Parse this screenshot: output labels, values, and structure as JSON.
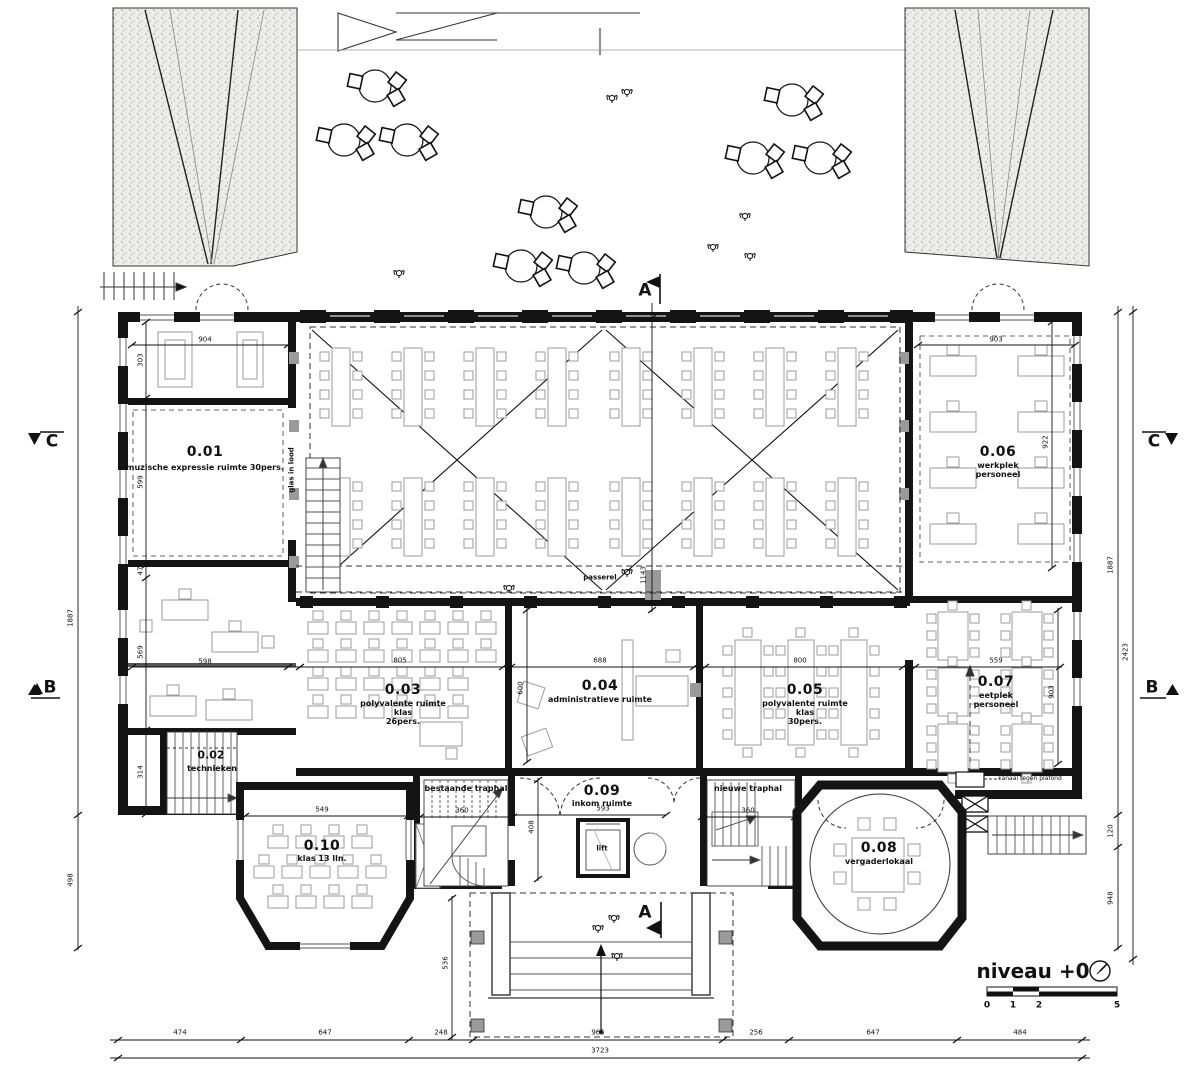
{
  "title": {
    "level_label": "niveau +0"
  },
  "scale_bar": {
    "t0": "0",
    "t1": "1",
    "t2": "2",
    "t5": "5"
  },
  "section_markers": {
    "a": "A",
    "b": "B",
    "c": "C"
  },
  "rooms": [
    {
      "number": "0.01",
      "lines": [
        "muzische expressie ruimte 30pers."
      ]
    },
    {
      "number": "0.02",
      "lines": [
        "technieken"
      ]
    },
    {
      "number": "0.03",
      "lines": [
        "polyvalente ruimte",
        "klas",
        "26pers."
      ]
    },
    {
      "number": "0.04",
      "lines": [
        "administratieve ruimte"
      ]
    },
    {
      "number": "0.05",
      "lines": [
        "polyvalente ruimte",
        "klas",
        "30pers."
      ]
    },
    {
      "number": "0.06",
      "lines": [
        "werkplek",
        "personeel"
      ]
    },
    {
      "number": "0.07",
      "lines": [
        "eetplek",
        "personeel"
      ]
    },
    {
      "number": "0.08",
      "lines": [
        "vergaderlokaal"
      ]
    },
    {
      "number": "0.09",
      "lines": [
        "inkom ruimte"
      ]
    },
    {
      "number": "0.10",
      "lines": [
        "klas 13 lln."
      ]
    }
  ],
  "annotations": {
    "glas_in_lood": "glas in lood",
    "passerel": "passerel",
    "bestaande_traphal": "bestaande traphal",
    "nieuwe_traphal": "nieuwe traphal",
    "lift": "lift",
    "kanaal": "kanaal tegen plafond"
  },
  "dimensions": {
    "bottom": [
      "474",
      "647",
      "248",
      "965",
      "256",
      "647",
      "484"
    ],
    "bottom_total": "3723",
    "left": [
      "1887",
      "498"
    ],
    "right": [
      "1887",
      "120",
      "948"
    ],
    "right_outer": "2423",
    "interior": {
      "d904": "904",
      "d303": "303",
      "d599": "599",
      "d47": "47",
      "d569": "569",
      "d598": "598",
      "d314": "314",
      "d805": "805",
      "d688": "688",
      "d600": "600",
      "d800": "800",
      "d559": "559",
      "d903_top": "903",
      "d922": "922",
      "d903_right": "903",
      "d549": "549",
      "d360_left": "360",
      "d593": "593",
      "d408": "408",
      "d360_right": "360",
      "d536": "536",
      "d1143": "1143"
    }
  },
  "colors": {
    "ink": "#141414",
    "furniture": "#9b9b9b",
    "ground": "#ececea"
  }
}
